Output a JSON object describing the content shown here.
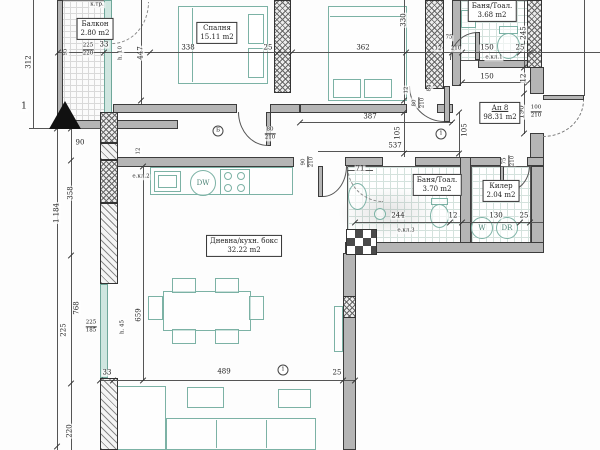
{
  "drawing_type": "apartment floor plan",
  "rooms": {
    "balcony": {
      "name": "Балкон",
      "area": "2.80 m2"
    },
    "bedroom": {
      "name": "Спалня",
      "area": "15.11 m2"
    },
    "bath_top": {
      "name": "Баня/Тоал.",
      "area": "3.68 m2"
    },
    "apartment": {
      "name": "Ап 8",
      "area": "98.31 m2"
    },
    "bath_mid": {
      "name": "Баня/Тоал.",
      "area": "3.70 m2"
    },
    "closet": {
      "name": "Килер",
      "area": "2.04 m2"
    },
    "living": {
      "name": "Дневна/кухн. бокс",
      "area": "32.22 m2"
    }
  },
  "appliances": {
    "dishwasher": "DW",
    "washer": "W",
    "dryer": "DR"
  },
  "annotations": {
    "ekl1": "е.кл.1",
    "ekl2": "е.кл.2",
    "ekl3": "е.кл.3",
    "ktr": "к.тр.",
    "h10": "h. 10",
    "h45": "h. 45"
  },
  "markers": {
    "section": "1",
    "axis_b": "Б",
    "axis_1a": "1",
    "axis_1b": "1"
  },
  "colors": {
    "furniture": "#7cb2a5",
    "wall": "#b5b5b5",
    "line": "#3c3c3c"
  },
  "dims": {
    "l312": "312",
    "l1184": "1 184",
    "l90": "90",
    "l358": "358",
    "l768": "768",
    "l225": "225",
    "s225": "225",
    "s185": "185",
    "l220": "220",
    "b95": "95",
    "b225": "225",
    "b220": "220",
    "b33": "33",
    "c447": "447",
    "t338": "338",
    "t25": "25",
    "t362": "362",
    "c330": "330",
    "w75": "75",
    "w12": "12",
    "w210": "210",
    "w150": "150",
    "w25": "25",
    "r245": "245",
    "r12": "12",
    "r190": "190",
    "r100": "100",
    "r210": "210",
    "h387": "387",
    "h105a": "105",
    "h105b": "105",
    "h537": "537",
    "h150": "150",
    "d12": "12",
    "d84": "84",
    "d80": "80",
    "d210": "210",
    "bd80": "80",
    "bd210": "210",
    "g90": "90",
    "g210": "210",
    "q71": "71",
    "q244": "244",
    "q12": "12",
    "k130": "130",
    "k25": "25",
    "k75": "75",
    "k210": "210",
    "m33": "33",
    "m489": "489",
    "m25": "25",
    "v659": "659",
    "k12": "12"
  }
}
